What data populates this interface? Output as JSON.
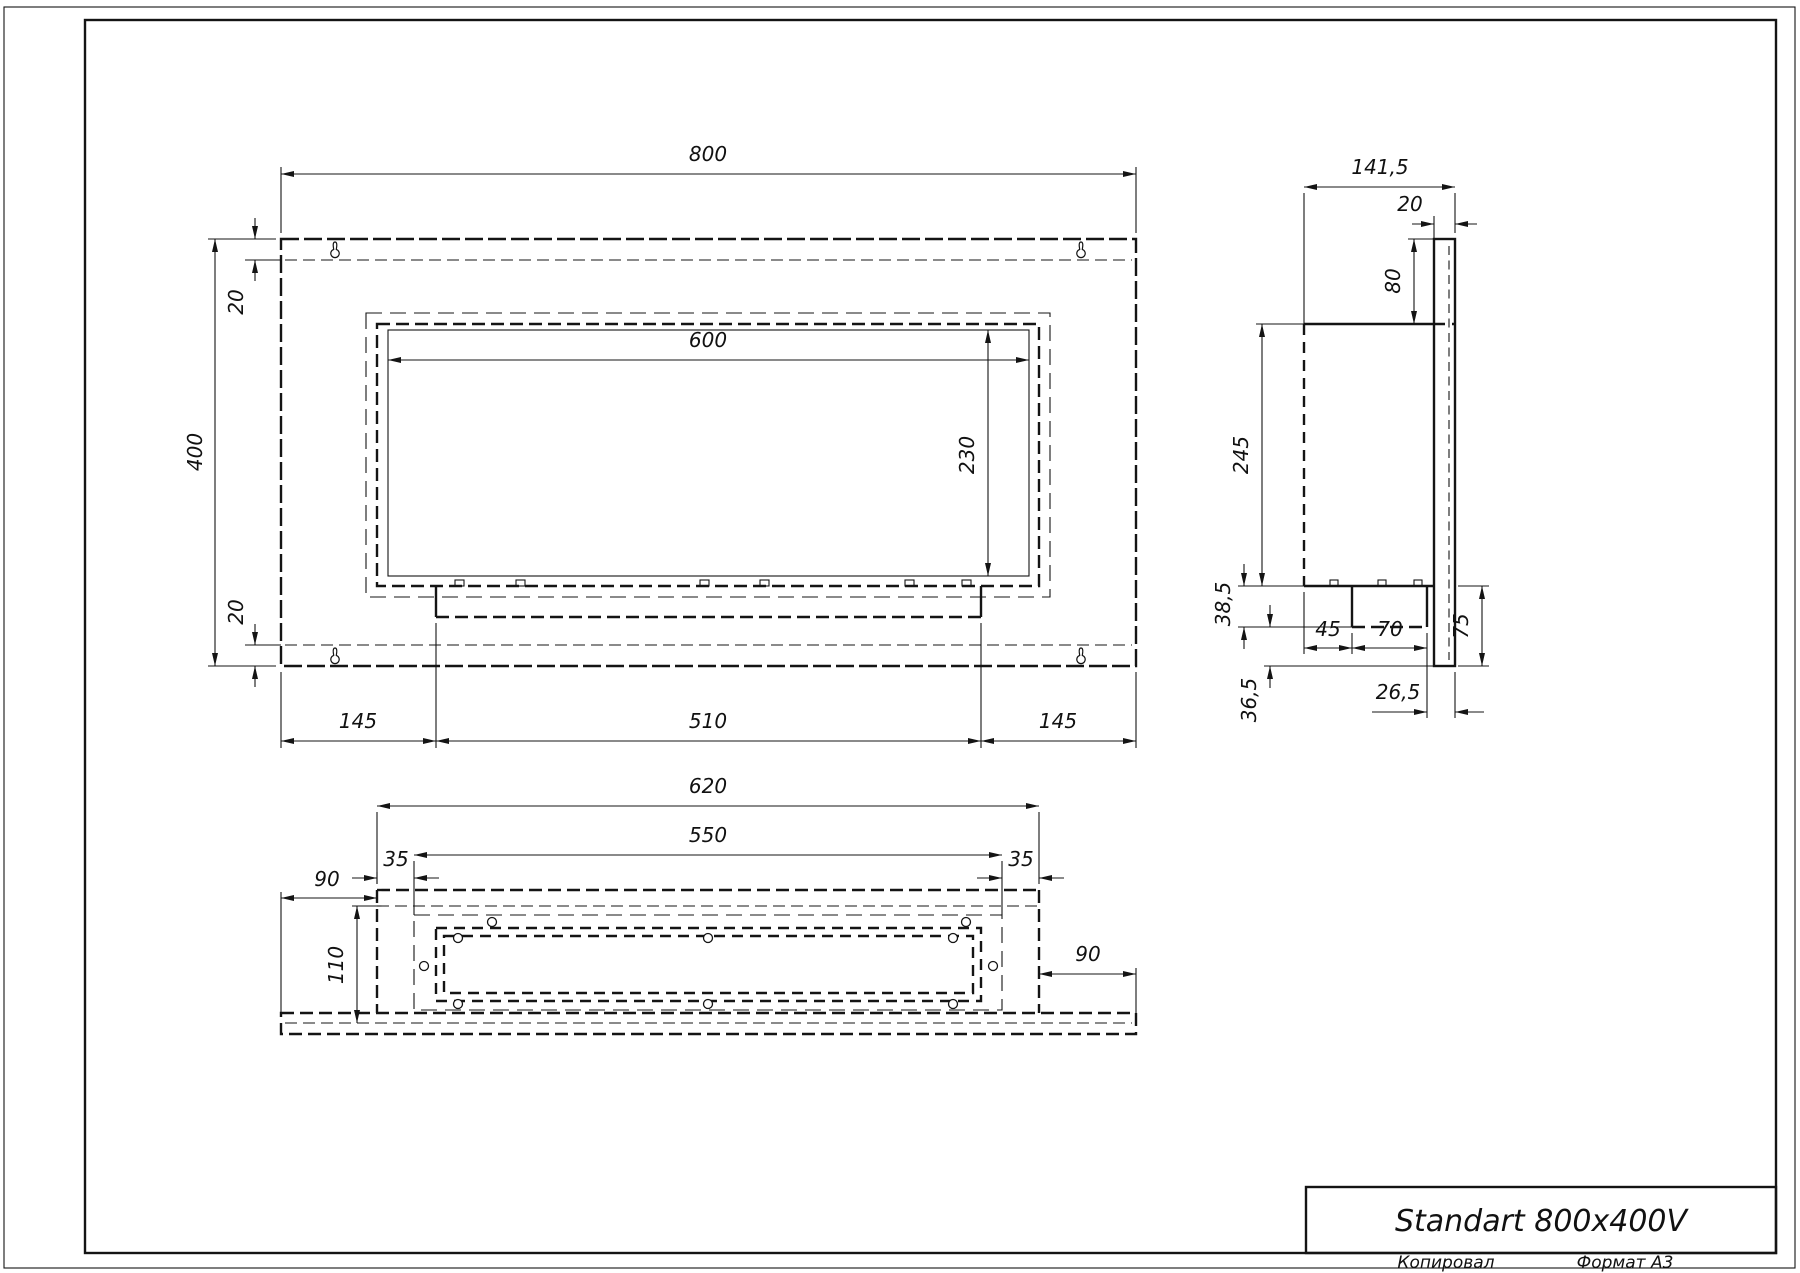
{
  "title_block": {
    "name": "Standart 800x400V"
  },
  "footer": {
    "copied": "Копировал",
    "format": "Формат A3"
  },
  "front_view": {
    "dims": {
      "width": "800",
      "height": "400",
      "offset_top": "20",
      "offset_bottom": "20",
      "opening_width": "600",
      "opening_height": "230",
      "margin_left": "145",
      "tray_width": "510",
      "margin_right": "145"
    }
  },
  "side_view": {
    "dims": {
      "depth": "141,5",
      "plate_thickness": "20",
      "top_to_body": "80",
      "body_height": "245",
      "tray_drop": "38,5",
      "below_tray": "36,5",
      "front_to_tray": "45",
      "tray_depth": "70",
      "rear_gap": "26,5",
      "plate_below": "75"
    }
  },
  "bottom_view": {
    "dims": {
      "box_width": "620",
      "frame_width": "550",
      "inset_left": "35",
      "inset_right": "35",
      "margin_left": "90",
      "margin_right": "90",
      "depth": "110"
    }
  }
}
